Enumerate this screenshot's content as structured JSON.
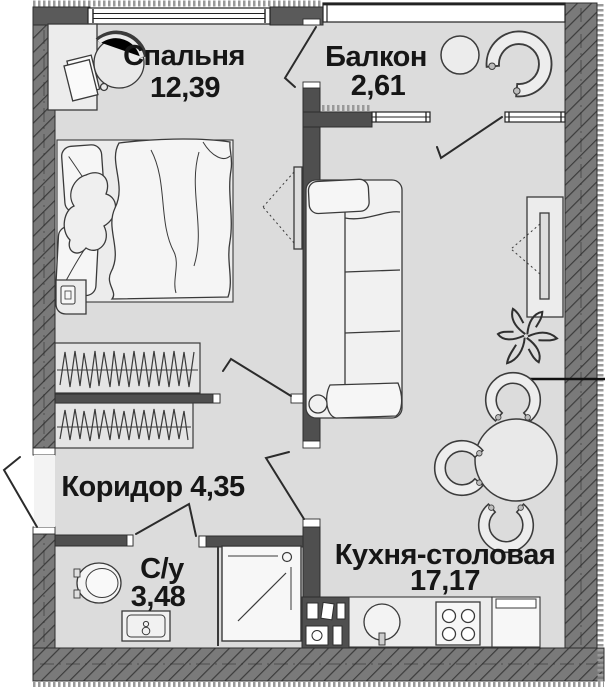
{
  "plan": {
    "type": "apartment-floor-plan",
    "rooms": {
      "bedroom": {
        "name": "Спальня",
        "area": "12,39"
      },
      "balcony": {
        "name": "Балкон",
        "area": "2,61"
      },
      "corridor": {
        "label": "Коридор 4,35"
      },
      "bathroom": {
        "name": "С/у",
        "area": "3,48"
      },
      "kitchen": {
        "name": "Кухня-столовая",
        "area": "17,17"
      }
    },
    "furniture": {
      "bedroom": [
        "double-bed",
        "pillows",
        "duvet",
        "desk",
        "desk-chair",
        "papers",
        "nightstand",
        "wall-tv",
        "wardrobe"
      ],
      "balcony": [
        "side-table",
        "c-armchair"
      ],
      "kitchen_living": [
        "sofa",
        "tv-stand",
        "tv",
        "plant",
        "dining-table",
        "dining-chair",
        "dining-chair",
        "dining-chair",
        "kitchen-counter",
        "sink",
        "stove",
        "fridge",
        "vent-shaft"
      ],
      "corridor": [
        "wardrobe",
        "entrance-door"
      ],
      "bathroom": [
        "toilet",
        "washbasin",
        "shower-cabin"
      ]
    },
    "colors": {
      "floor": "#dcdcdc",
      "exterior_wall": "#7a7a7a",
      "interior_wall": "#4f4f4f",
      "hatch_line": "#3c3c3c",
      "outline": "#2e2e2e",
      "furniture_fill": "#f2f2f2",
      "window_fill": "#ffffff",
      "text": "#161616"
    }
  }
}
